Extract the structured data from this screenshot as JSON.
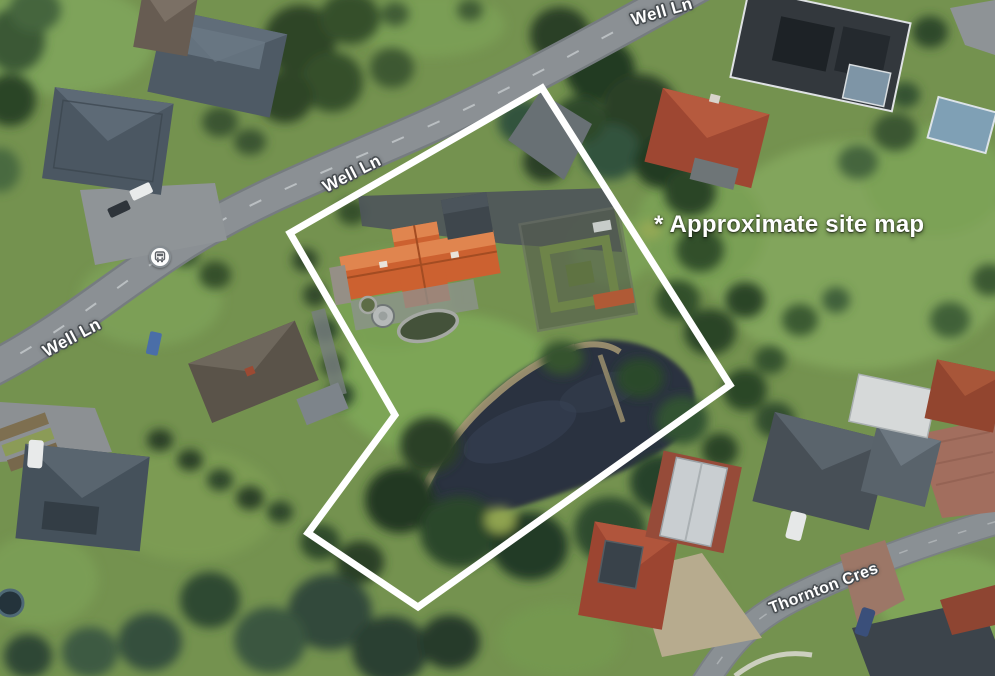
{
  "page": {
    "type": "aerial-satellite-site-map"
  },
  "annotation": {
    "text": "* Approximate site map"
  },
  "road_labels": {
    "well_ln_top": "Well Ln",
    "well_ln_mid": "Well Ln",
    "well_ln_left": "Well Ln",
    "thornton_cres": "Thornton Cres"
  },
  "site_outline": {
    "points": "542,88 290,233 395,415 308,533 418,607 730,385",
    "stroke_color": "#ffffff",
    "stroke_width": 7
  },
  "icons": {
    "bus_stop": "bus-stop-transit-icon"
  },
  "colors": {
    "outline": "#ffffff",
    "label_text": "#ffffff",
    "label_halo": "#474c50",
    "grass": "#74924f",
    "water": "#2a333f",
    "road": "#8b9094"
  }
}
